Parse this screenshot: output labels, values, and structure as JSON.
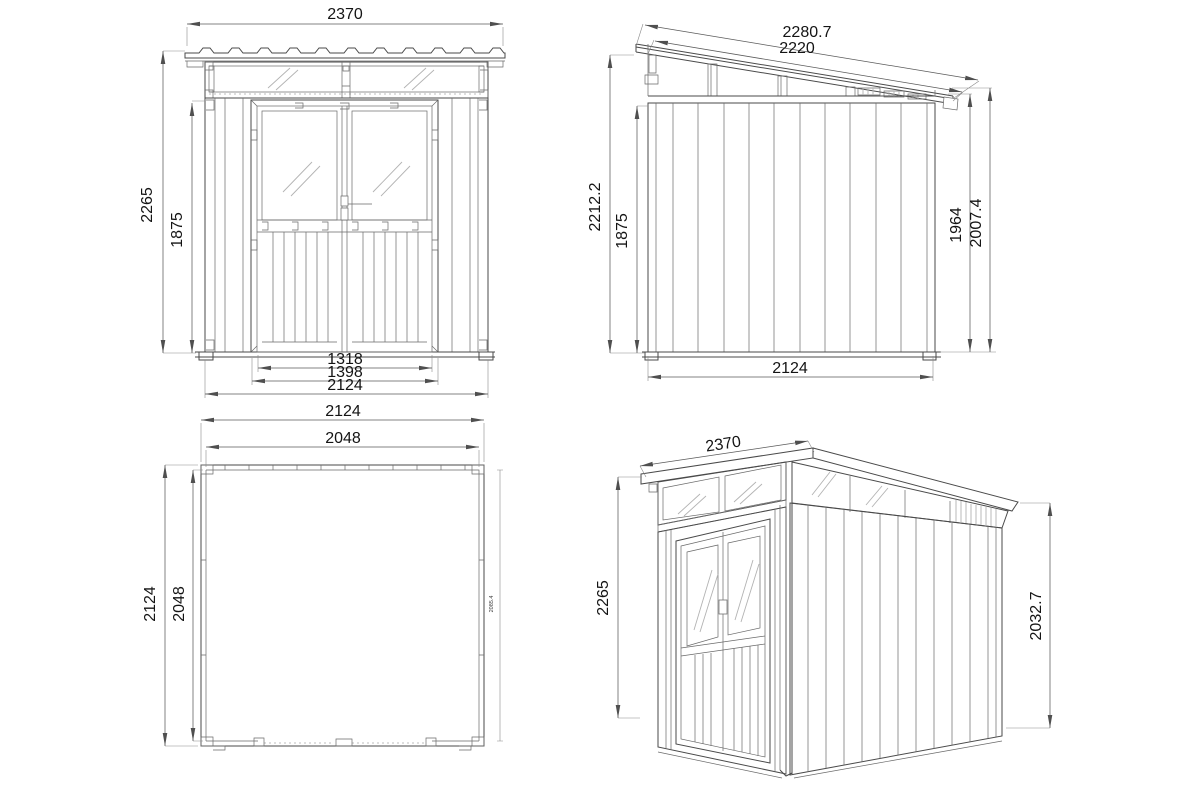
{
  "drawing": {
    "views": {
      "front_elevation": {
        "dimensions": {
          "roof_width": "2370",
          "overall_height": "2265",
          "wall_height": "1875",
          "door_opening_width": "1318",
          "door_frame_width": "1398",
          "base_width": "2124"
        }
      },
      "side_elevation": {
        "dimensions": {
          "roof_edge_outer": "2280.7",
          "roof_edge_inner": "2220",
          "high_side_height": "2212.2",
          "wall_height": "1875",
          "low_side_inner_height": "1964",
          "low_side_height": "2007.4",
          "base_depth": "2124"
        }
      },
      "floor_plan": {
        "dimensions": {
          "outer_width": "2124",
          "inner_width": "2048",
          "outer_depth": "2124",
          "inner_depth": "2048",
          "inner_depth_detail": "2085.4"
        }
      },
      "perspective": {
        "dimensions": {
          "roof_width": "2370",
          "front_height": "2265",
          "rear_height": "2032.7"
        }
      }
    },
    "colors": {
      "background": "#ffffff",
      "line": "#4a4a4a",
      "detail_line": "#6a6a6a",
      "glass_hatch": "#b3b3b3",
      "dimension_line": "#5a5a5a",
      "dimension_text": "#141414"
    }
  }
}
